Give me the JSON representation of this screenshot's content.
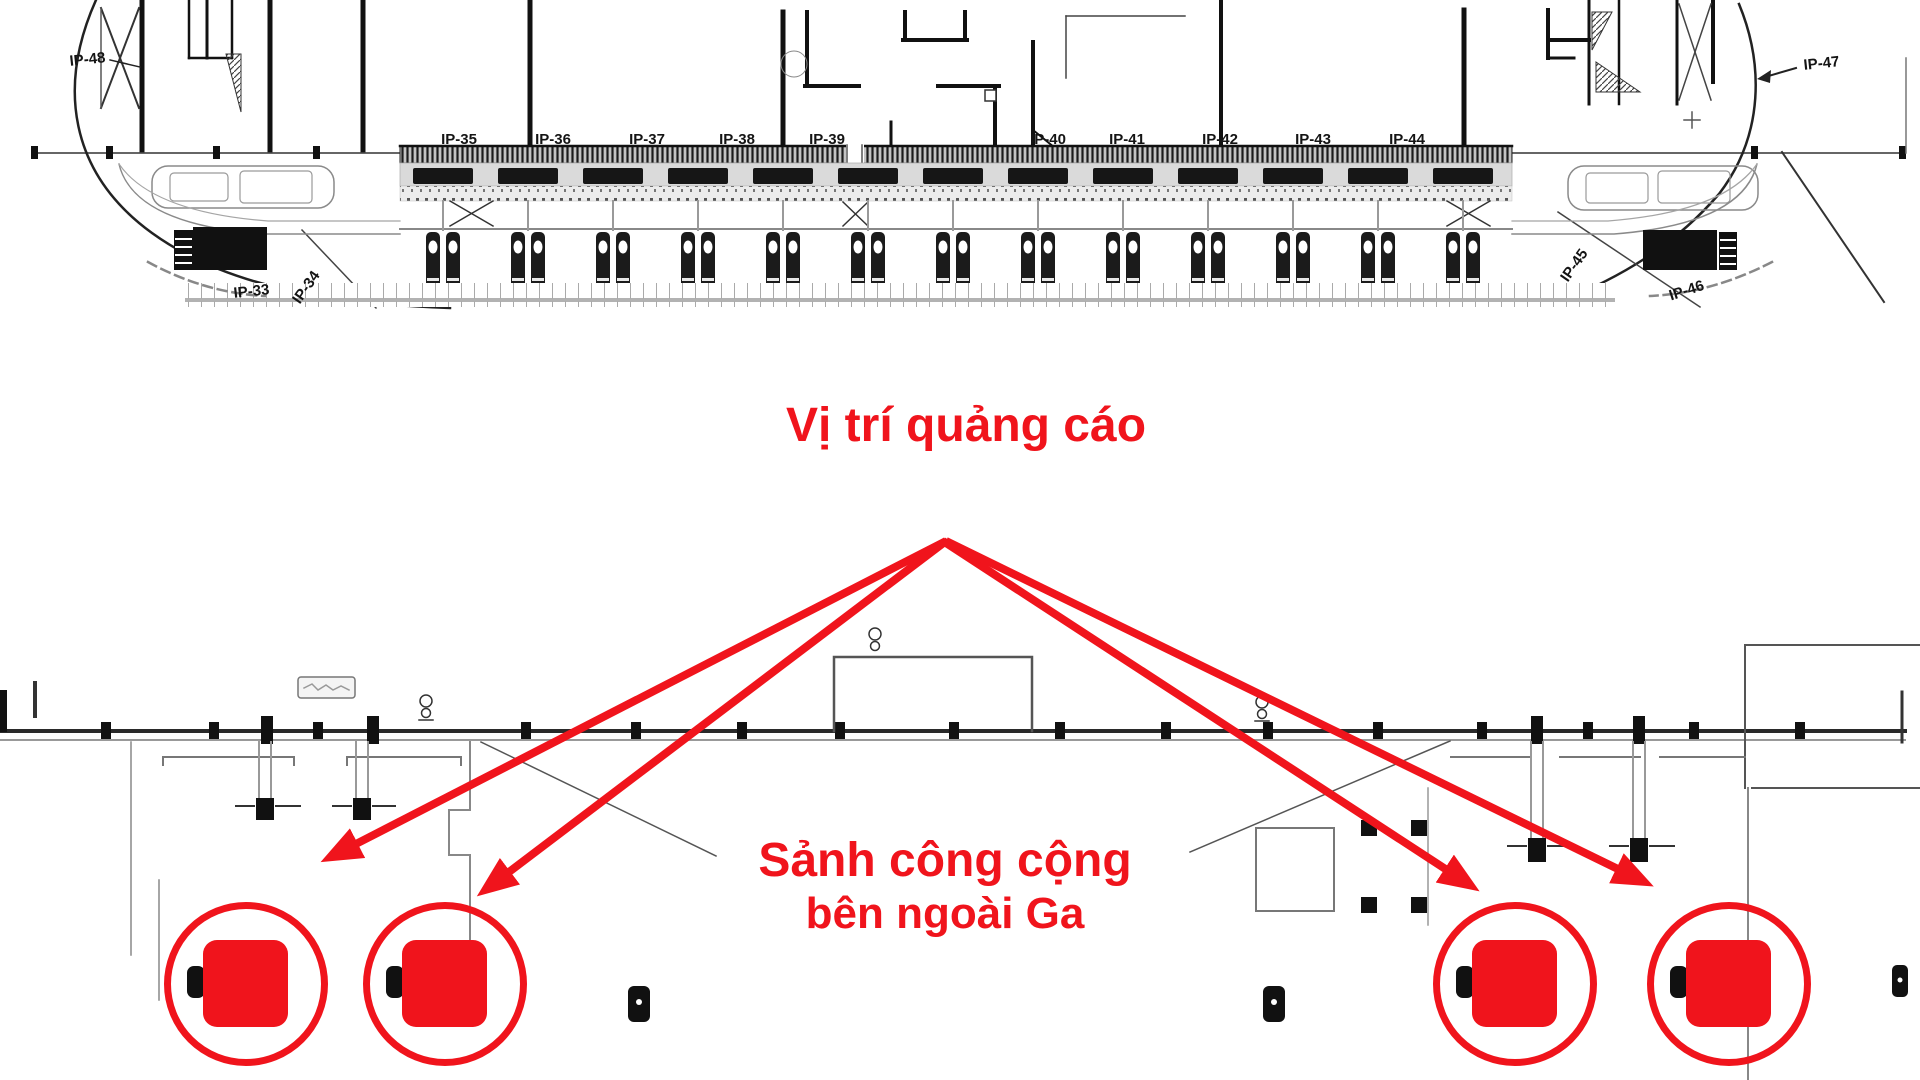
{
  "annotations": {
    "ad_position": "Vị trí quảng cáo",
    "public_hall_line1": "Sảnh công cộng",
    "public_hall_line2": "bên ngoài Ga"
  },
  "plan": {
    "platform_labels": [
      "IP-35",
      "IP-36",
      "IP-37",
      "IP-38",
      "IP-39",
      "IP-40",
      "IP-41",
      "IP-42",
      "IP-43",
      "IP-44"
    ],
    "corner_labels": {
      "top_left": "IP-48",
      "bottom_left_1": "IP-33",
      "bottom_left_2": "IP-34",
      "top_right": "IP-47",
      "bottom_right_1": "IP-45",
      "bottom_right_2": "IP-46"
    }
  },
  "colors": {
    "annotation_red": "#f0141c",
    "drawing_dark": "#1a1a1a",
    "drawing_grey": "#8a8a8a"
  }
}
